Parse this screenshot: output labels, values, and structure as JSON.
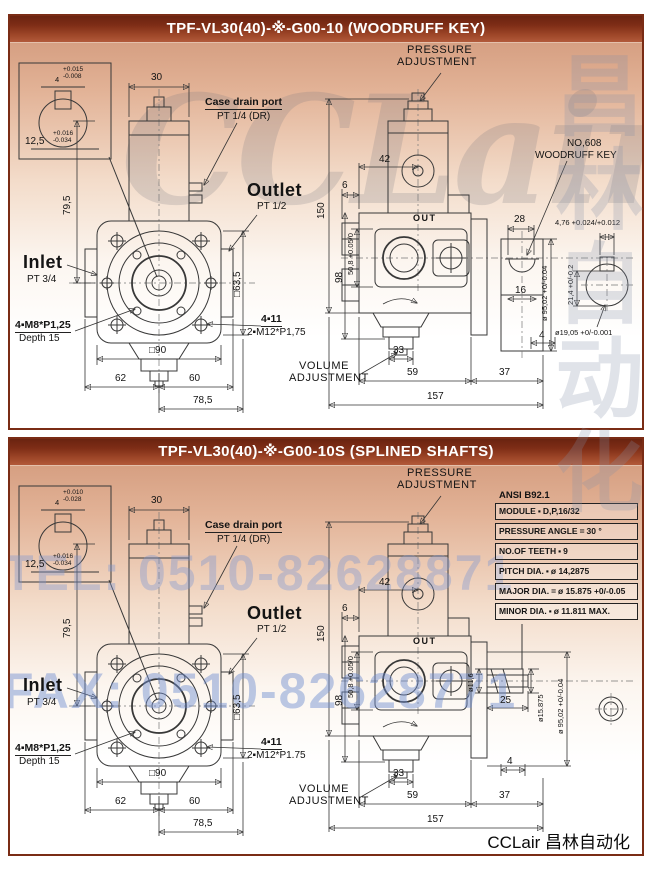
{
  "watermarks": {
    "brand_large": "CCLair",
    "brand_cn": "昌林自动化",
    "tel": "TEL: 0510-82628871",
    "fax": "FAX: 0510-82628771"
  },
  "footer": {
    "brand": "CCLair 昌林自动化"
  },
  "colors": {
    "title_bar_top": "#6a2310",
    "title_bar_bottom": "#b25a3a",
    "panel_border": "#7a2c15",
    "panel_background_peach": "#cf9577",
    "drawing_line": "#383838",
    "watermark_blue": "#7b96d2"
  },
  "panels": [
    {
      "title": "TPF-VL30(40)-※-G00-10 (WOODRUFF KEY)",
      "variant": "woodruff-key",
      "labels": [
        {
          "t": "30",
          "x": 140,
          "y": 30,
          "c": "d"
        },
        {
          "t": "4",
          "x": 44,
          "y": 33,
          "c": "ds"
        },
        {
          "t": "+0.015\n-0.008",
          "x": 52,
          "y": 24,
          "c": "tol"
        },
        {
          "t": "12,5",
          "x": 14,
          "y": 94,
          "c": "d"
        },
        {
          "t": "+0.016\n-0.034",
          "x": 42,
          "y": 88,
          "c": "tol"
        },
        {
          "t": "Case drain port",
          "x": 194,
          "y": 54,
          "c": "cu",
          "n": "case-drain-port-label"
        },
        {
          "t": "PT 1/4 (DR)",
          "x": 206,
          "y": 69,
          "c": "c2"
        },
        {
          "t": "Outlet",
          "x": 236,
          "y": 138,
          "c": "big",
          "n": "outlet-label"
        },
        {
          "t": "PT 1/2",
          "x": 246,
          "y": 159,
          "c": "c2"
        },
        {
          "t": "79,5",
          "x": 52,
          "y": 172,
          "c": "d",
          "r": -90
        },
        {
          "t": "Inlet",
          "x": 12,
          "y": 210,
          "c": "big",
          "n": "inlet-label"
        },
        {
          "t": "PT 3/4",
          "x": 16,
          "y": 232,
          "c": "c2"
        },
        {
          "t": "4▪M8*P1,25",
          "x": 4,
          "y": 277,
          "c": "cu"
        },
        {
          "t": "Depth 15",
          "x": 8,
          "y": 291,
          "c": "c2"
        },
        {
          "t": "4▪11",
          "x": 250,
          "y": 271,
          "c": "cu"
        },
        {
          "t": "2▪M12*P1,75",
          "x": 236,
          "y": 285,
          "c": "c2"
        },
        {
          "t": "□90",
          "x": 138,
          "y": 303,
          "c": "d"
        },
        {
          "t": "62",
          "x": 104,
          "y": 331,
          "c": "d"
        },
        {
          "t": "60",
          "x": 178,
          "y": 331,
          "c": "d"
        },
        {
          "t": "78,5",
          "x": 182,
          "y": 353,
          "c": "d"
        },
        {
          "t": "□63,5",
          "x": 222,
          "y": 254,
          "c": "d",
          "r": -90
        },
        {
          "t": "PRESSURE",
          "x": 396,
          "y": 2,
          "c": "cap",
          "n": "pressure-adjustment-label"
        },
        {
          "t": "ADJUSTMENT",
          "x": 386,
          "y": 14,
          "c": "cap"
        },
        {
          "t": "150",
          "x": 306,
          "y": 176,
          "c": "d",
          "r": -90
        },
        {
          "t": "42",
          "x": 368,
          "y": 112,
          "c": "d"
        },
        {
          "t": "6",
          "x": 331,
          "y": 138,
          "c": "d"
        },
        {
          "t": "NO,608",
          "x": 556,
          "y": 96,
          "c": "c2"
        },
        {
          "t": "WOODRUFF KEY",
          "x": 524,
          "y": 108,
          "c": "c2"
        },
        {
          "t": "OUT",
          "x": 402,
          "y": 171,
          "c": "out"
        },
        {
          "t": "28",
          "x": 503,
          "y": 172,
          "c": "d"
        },
        {
          "t": "16",
          "x": 504,
          "y": 243,
          "c": "d"
        },
        {
          "t": "ø 95,02 +0/-0.04",
          "x": 530,
          "y": 278,
          "c": "ds",
          "r": -90
        },
        {
          "t": "4",
          "x": 528,
          "y": 288,
          "c": "d"
        },
        {
          "t": "50,8 +0.05/0",
          "x": 336,
          "y": 232,
          "c": "ds",
          "r": -90
        },
        {
          "t": "98",
          "x": 324,
          "y": 240,
          "c": "d",
          "r": -90
        },
        {
          "t": "VOLUME",
          "x": 288,
          "y": 318,
          "c": "cap",
          "n": "volume-adjustment-label"
        },
        {
          "t": "ADJUSTMENT",
          "x": 278,
          "y": 330,
          "c": "cap"
        },
        {
          "t": "33",
          "x": 382,
          "y": 303,
          "c": "d"
        },
        {
          "t": "59",
          "x": 396,
          "y": 325,
          "c": "d"
        },
        {
          "t": "37",
          "x": 488,
          "y": 325,
          "c": "d"
        },
        {
          "t": "157",
          "x": 416,
          "y": 349,
          "c": "d"
        },
        {
          "t": "4,76 +0.024/+0.012",
          "x": 544,
          "y": 176,
          "c": "ds"
        },
        {
          "t": "21,4 +0/-0.2",
          "x": 556,
          "y": 262,
          "c": "ds",
          "r": -90
        },
        {
          "t": "ø19,05 +0/-0.001",
          "x": 544,
          "y": 286,
          "c": "ds"
        }
      ]
    },
    {
      "title": "TPF-VL30(40)-※-G00-10S (SPLINED SHAFTS)",
      "variant": "splined-shafts",
      "spline_table": {
        "header": "ANSI B92.1",
        "rows": [
          {
            "name": "MODULE",
            "sep": "▪",
            "value": "D,P,16/32"
          },
          {
            "name": "PRESSURE ANGLE",
            "sep": "=",
            "value": "30 °"
          },
          {
            "name": "NO.OF TEETH",
            "sep": "▪",
            "value": "9"
          },
          {
            "name": "PITCH DIA.",
            "sep": "▪",
            "value": "ø 14,2875"
          },
          {
            "name": "MAJOR DIA.",
            "sep": "=",
            "value": "ø 15.875 +0/-0.05"
          },
          {
            "name": "MINOR DIA.",
            "sep": "▪",
            "value": "ø 11.811 MAX."
          }
        ]
      },
      "labels": [
        {
          "t": "30",
          "x": 140,
          "y": 30,
          "c": "d"
        },
        {
          "t": "4",
          "x": 44,
          "y": 33,
          "c": "ds"
        },
        {
          "t": "+0.010\n-0.028",
          "x": 52,
          "y": 24,
          "c": "tol"
        },
        {
          "t": "12,5",
          "x": 14,
          "y": 94,
          "c": "d"
        },
        {
          "t": "+0.016\n-0.034",
          "x": 42,
          "y": 88,
          "c": "tol"
        },
        {
          "t": "Case drain port",
          "x": 194,
          "y": 54,
          "c": "cu",
          "n": "case-drain-port-label"
        },
        {
          "t": "PT 1/4 (DR)",
          "x": 206,
          "y": 69,
          "c": "c2"
        },
        {
          "t": "Outlet",
          "x": 236,
          "y": 138,
          "c": "big",
          "n": "outlet-label"
        },
        {
          "t": "PT 1/2",
          "x": 246,
          "y": 159,
          "c": "c2"
        },
        {
          "t": "79,5",
          "x": 52,
          "y": 172,
          "c": "d",
          "r": -90
        },
        {
          "t": "Inlet",
          "x": 12,
          "y": 210,
          "c": "big",
          "n": "inlet-label"
        },
        {
          "t": "PT 3/4",
          "x": 16,
          "y": 232,
          "c": "c2"
        },
        {
          "t": "4▪M8*P1,25",
          "x": 4,
          "y": 277,
          "c": "cu"
        },
        {
          "t": "Depth 15",
          "x": 8,
          "y": 291,
          "c": "c2"
        },
        {
          "t": "4▪11",
          "x": 250,
          "y": 271,
          "c": "cu"
        },
        {
          "t": "2▪M12*P1.75",
          "x": 236,
          "y": 285,
          "c": "c2"
        },
        {
          "t": "□90",
          "x": 138,
          "y": 303,
          "c": "d"
        },
        {
          "t": "62",
          "x": 104,
          "y": 331,
          "c": "d"
        },
        {
          "t": "60",
          "x": 178,
          "y": 331,
          "c": "d"
        },
        {
          "t": "78,5",
          "x": 182,
          "y": 353,
          "c": "d"
        },
        {
          "t": "□63,5",
          "x": 222,
          "y": 254,
          "c": "d",
          "r": -90
        },
        {
          "t": "PRESSURE",
          "x": 396,
          "y": 2,
          "c": "cap",
          "n": "pressure-adjustment-label"
        },
        {
          "t": "ADJUSTMENT",
          "x": 386,
          "y": 14,
          "c": "cap"
        },
        {
          "t": "150",
          "x": 306,
          "y": 176,
          "c": "d",
          "r": -90
        },
        {
          "t": "42",
          "x": 368,
          "y": 112,
          "c": "d"
        },
        {
          "t": "6",
          "x": 331,
          "y": 138,
          "c": "d"
        },
        {
          "t": "OUT",
          "x": 402,
          "y": 171,
          "c": "out"
        },
        {
          "t": "50,8 +0.05/0",
          "x": 336,
          "y": 232,
          "c": "ds",
          "r": -90
        },
        {
          "t": "98",
          "x": 324,
          "y": 240,
          "c": "d",
          "r": -90
        },
        {
          "t": "VOLUME",
          "x": 288,
          "y": 318,
          "c": "cap",
          "n": "volume-adjustment-label"
        },
        {
          "t": "ADJUSTMENT",
          "x": 278,
          "y": 330,
          "c": "cap"
        },
        {
          "t": "33",
          "x": 382,
          "y": 303,
          "c": "d"
        },
        {
          "t": "59",
          "x": 396,
          "y": 325,
          "c": "d"
        },
        {
          "t": "37",
          "x": 488,
          "y": 325,
          "c": "d"
        },
        {
          "t": "157",
          "x": 416,
          "y": 349,
          "c": "d"
        },
        {
          "t": "ø11,6",
          "x": 456,
          "y": 226,
          "c": "ds",
          "r": -90
        },
        {
          "t": "ø15.875",
          "x": 526,
          "y": 256,
          "c": "ds",
          "r": -90
        },
        {
          "t": "25",
          "x": 489,
          "y": 230,
          "c": "d"
        },
        {
          "t": "ø 95,02 +0/-0.04",
          "x": 546,
          "y": 268,
          "c": "ds",
          "r": -90
        },
        {
          "t": "4",
          "x": 496,
          "y": 291,
          "c": "d"
        }
      ]
    }
  ]
}
